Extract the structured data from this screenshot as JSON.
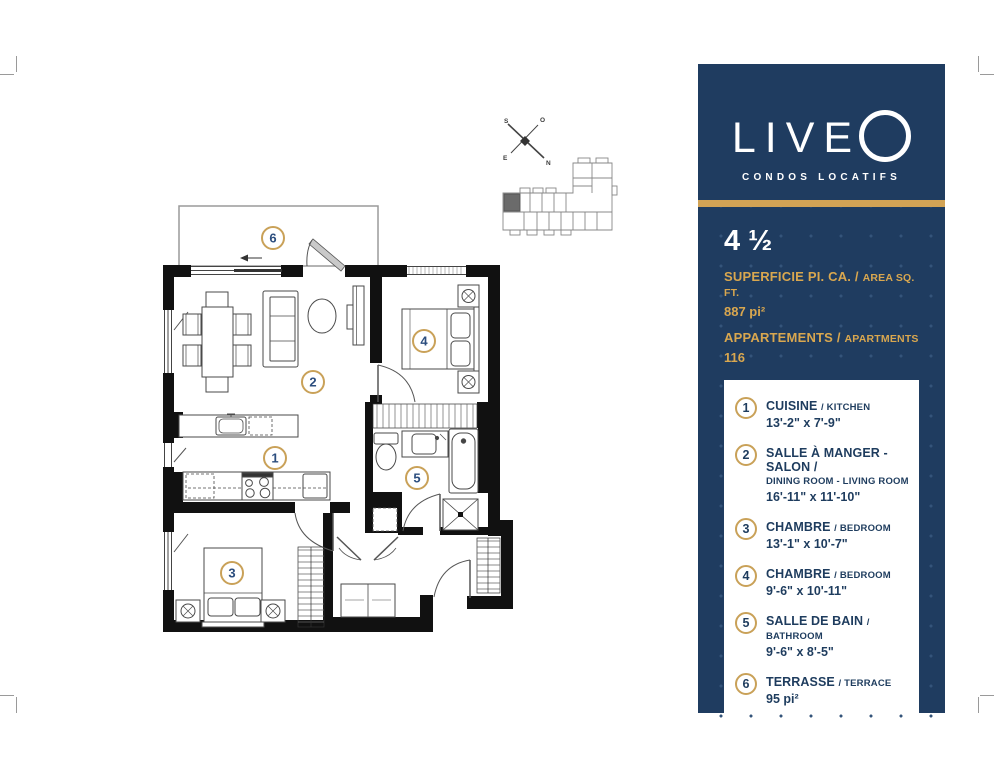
{
  "branding": {
    "logo": "LIVE",
    "tagline": "CONDOS LOCATIFS"
  },
  "panel": {
    "unit_type": "4 ½",
    "area_label_fr": "SUPERFICIE PI. CA. /",
    "area_label_en": "AREA SQ. FT.",
    "area_value": "887 pi²",
    "apartments_label_fr": "APPARTEMENTS /",
    "apartments_label_en": "APARTMENTS",
    "apartments_value": "116",
    "legend": [
      {
        "num": "1",
        "fr": "CUISINE",
        "en": "/ KITCHEN",
        "dims": "13'-2\" x 7'-9\""
      },
      {
        "num": "2",
        "fr": "SALLE À MANGER - SALON /",
        "en": "DINING ROOM - LIVING ROOM",
        "dims": "16'-11\" x 11'-10\""
      },
      {
        "num": "3",
        "fr": "CHAMBRE",
        "en": "/ BEDROOM",
        "dims": "13'-1\" x 10'-7\""
      },
      {
        "num": "4",
        "fr": "CHAMBRE",
        "en": "/ BEDROOM",
        "dims": "9'-6\" x 10'-11\""
      },
      {
        "num": "5",
        "fr": "SALLE DE BAIN",
        "en": "/ BATHROOM",
        "dims": "9'-6\" x 8'-5\""
      },
      {
        "num": "6",
        "fr": "TERRASSE",
        "en": "/ TERRACE",
        "dims": "95 pi²"
      }
    ]
  },
  "floorplan": {
    "badges": [
      "1",
      "2",
      "3",
      "4",
      "5",
      "6"
    ],
    "compass": {
      "s": "S",
      "o": "O",
      "e": "E",
      "n": "N"
    }
  },
  "colors": {
    "navy": "#1f3c60",
    "gold": "#d2a355",
    "badge_ring": "#c9a158",
    "badge_number": "#2b4d7e"
  }
}
